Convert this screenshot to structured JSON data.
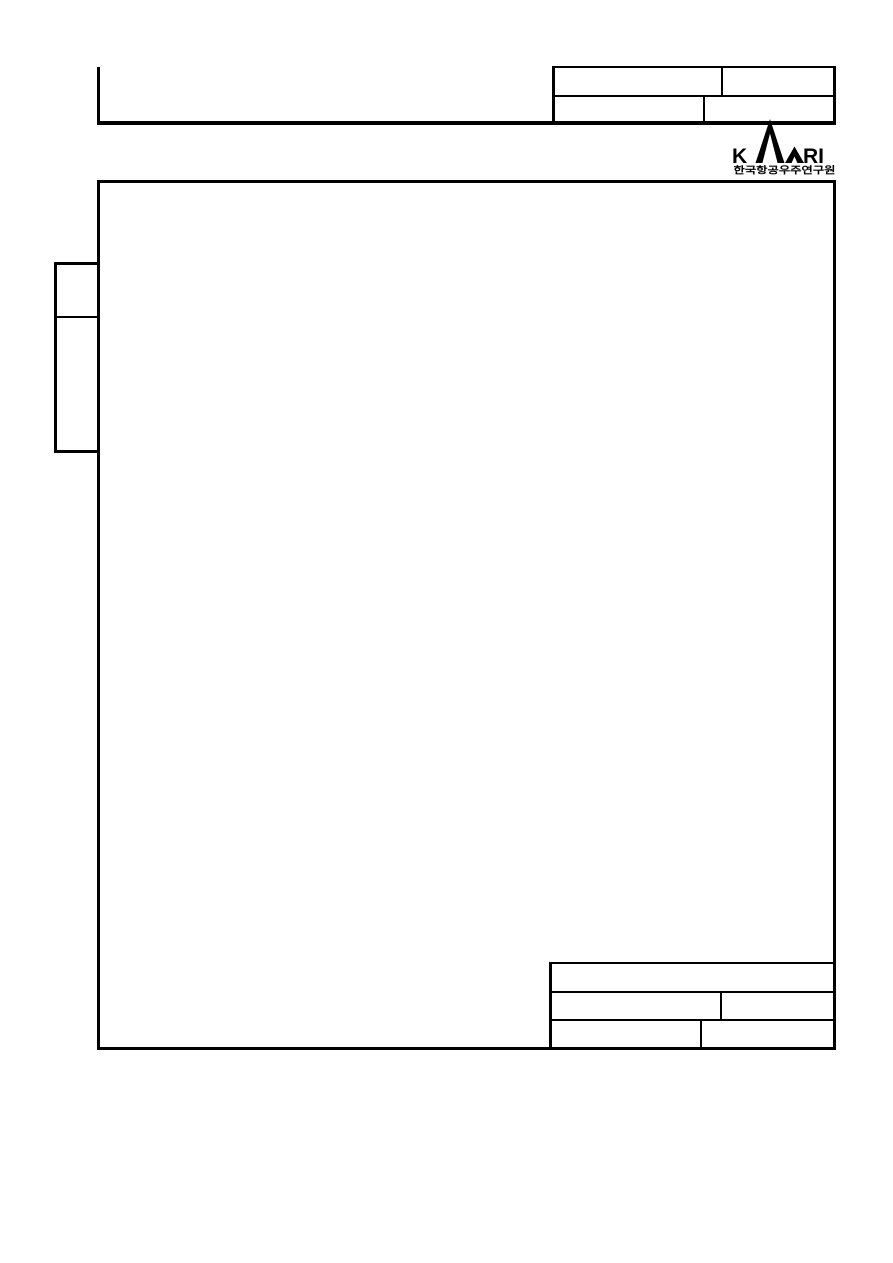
{
  "page": {
    "background": "#ffffff",
    "line_color": "#000000"
  },
  "header": {
    "revision_table": {
      "rows": [
        {
          "cells": [
            "",
            ""
          ]
        },
        {
          "cells": [
            "",
            ""
          ]
        }
      ]
    }
  },
  "logo": {
    "text_k": "K",
    "text_ri": "RI",
    "subtitle": "한국항공우주연구원"
  },
  "body_frame": {
    "content": ""
  },
  "side_tab": {
    "cells": [
      "",
      ""
    ]
  },
  "footer_table": {
    "rows": [
      {
        "cells": [
          ""
        ]
      },
      {
        "cells": [
          "",
          ""
        ]
      },
      {
        "cells": [
          "",
          ""
        ]
      }
    ]
  }
}
